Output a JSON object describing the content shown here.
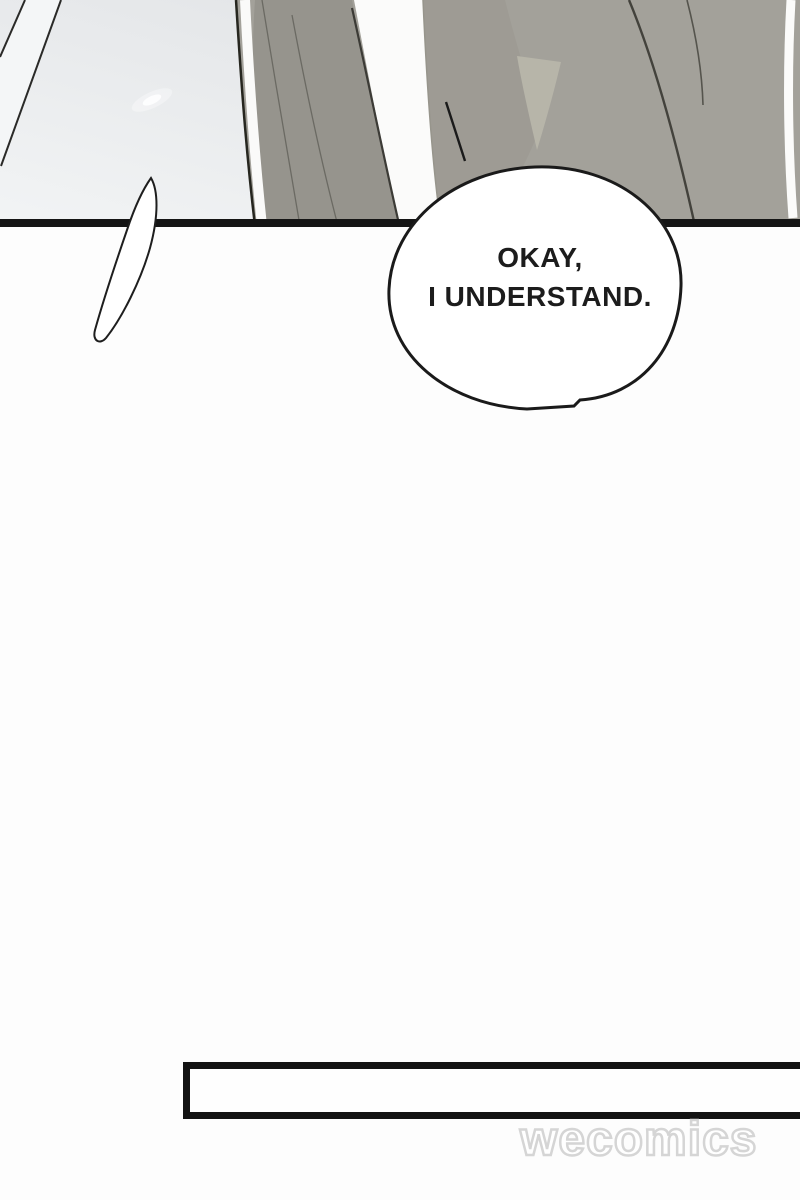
{
  "page": {
    "width": 800,
    "height": 1200,
    "background": "#fdfdfd",
    "description": "webtoon comic page: close-up of a torso in a gray suit above a speech bubble, large blank gap, then the top edge of the next panel and a watermark"
  },
  "top_panel": {
    "type": "comic-panel",
    "background_left": "#f2f4f5",
    "background_right": "#dddfe2",
    "panel_border_color": "#151515",
    "jacket_color": "#a3a19a",
    "jacket_shadow_color": "#96948d",
    "shirt_color": "#fbfbfa",
    "outline_color": "#26261f"
  },
  "speech_bubble": {
    "lines": {
      "0": "OKAY,",
      "1": "I UNDERSTAND."
    },
    "fill": "#ffffff",
    "stroke": "#1a1a1a",
    "text_color": "#1c1c1c"
  },
  "bottom_panel": {
    "type": "comic-panel-top-edge",
    "border_color": "#131313",
    "fill": "#fefefe"
  },
  "watermark": {
    "text": "wecomics",
    "outline_color": "#d5d5d5",
    "fill_color": "#ffffff"
  }
}
